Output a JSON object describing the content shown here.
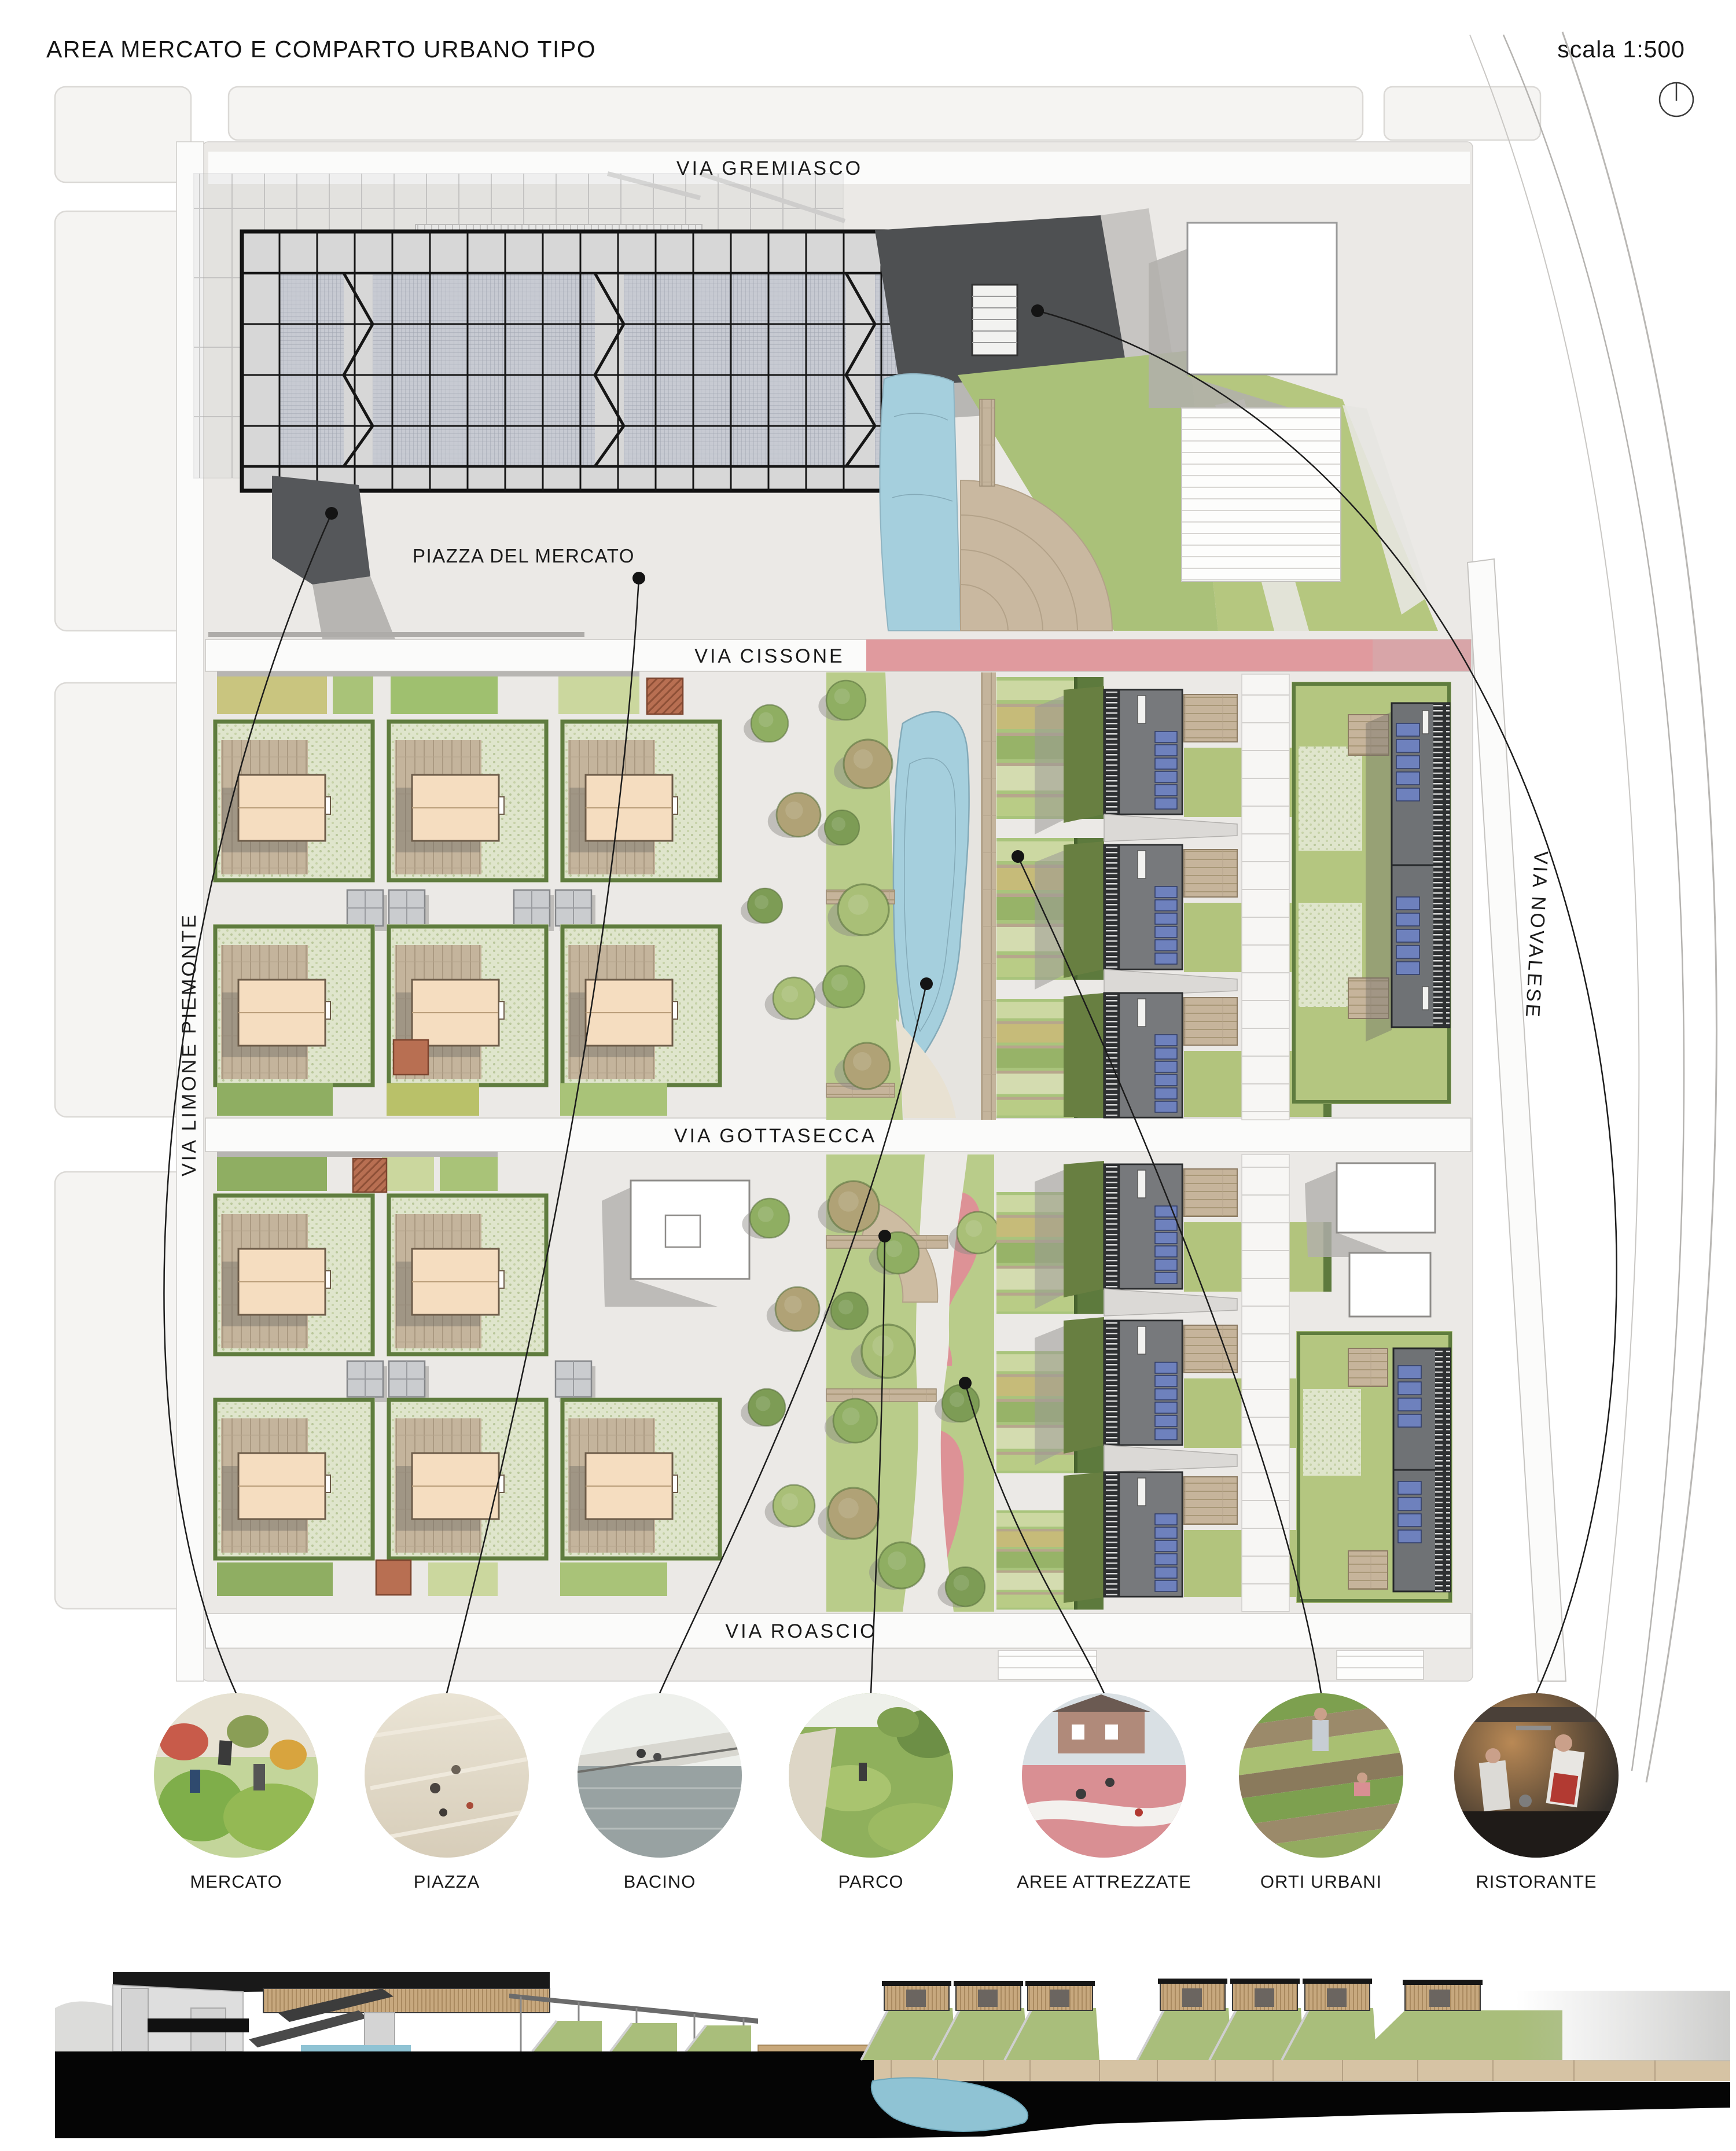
{
  "header": {
    "title": "AREA MERCATO E COMPARTO URBANO TIPO",
    "scale_label": "scala 1:500",
    "north_icon": "north-indicator"
  },
  "plan": {
    "streets": {
      "gremiasco": "VIA GREMIASCO",
      "cissone": "VIA CISSONE",
      "gottasecca": "VIA GOTTASECCA",
      "roascio": "VIA ROASCIO",
      "limone": "VIA LIMONE PIEMONTE",
      "novalese": "VIA NOVALESE"
    },
    "labels": {
      "piazza": "PIAZZA DEL MERCATO"
    }
  },
  "legend": {
    "items": [
      {
        "id": "mercato",
        "label": "MERCATO"
      },
      {
        "id": "piazza",
        "label": "PIAZZA"
      },
      {
        "id": "bacino",
        "label": "BACINO"
      },
      {
        "id": "parco",
        "label": "PARCO"
      },
      {
        "id": "aree-attrezzate",
        "label": "AREE ATTREZZATE"
      },
      {
        "id": "orti-urbani",
        "label": "ORTI URBANI"
      },
      {
        "id": "ristorante",
        "label": "RISTORANTE"
      }
    ]
  },
  "colors": {
    "paper": "#ffffff",
    "ground": "#ebe9e6",
    "street": "#fbfbfa",
    "water": "#a5cfdd",
    "lawn": "#aac179",
    "hedge": "#5f7c3e",
    "wood": "#c4b49c",
    "roof": "#f5ddc0",
    "darkbldg": "#4e5052",
    "solar": "#6e81bd",
    "pink": "#e09a9e",
    "playpink": "#dd9296",
    "ink": "#1a1a1a",
    "shadow": "#9a9896",
    "sectionblack": "#050505"
  }
}
